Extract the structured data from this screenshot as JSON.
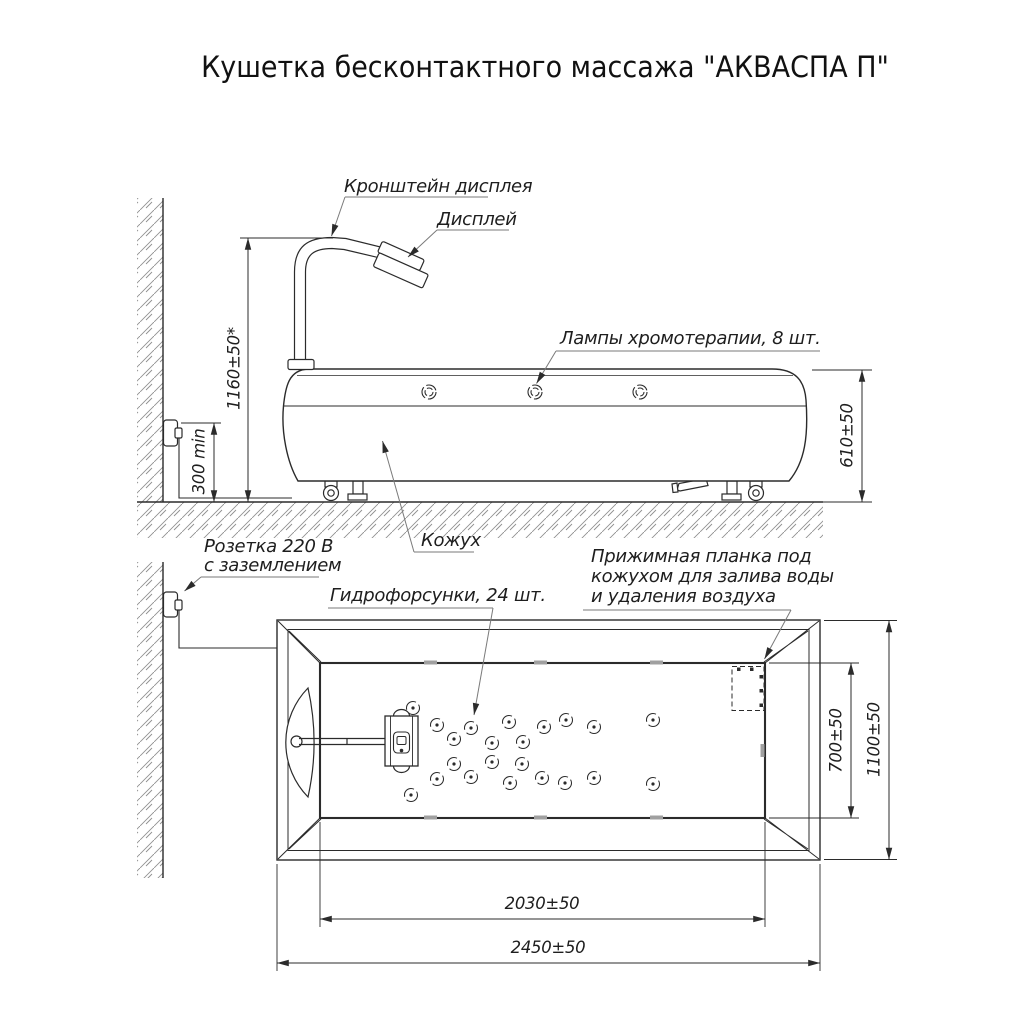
{
  "title": "Кушетка бесконтактного массажа \"АКВАСПА П\"",
  "side_view": {
    "labels": {
      "display_bracket": "Кронштейн дисплея",
      "display": "Дисплей",
      "lamps": "Лампы хромотерапии, 8 шт.",
      "casing": "Кожух",
      "socket_line1": "Розетка 220 В",
      "socket_line2": "с заземлением"
    },
    "dimensions": {
      "display_height": "1160±50*",
      "socket_height": "300 min",
      "couch_height": "610±50"
    }
  },
  "plan_view": {
    "labels": {
      "nozzles": "Гидрофорсунки, 24 шт.",
      "clamp_line1": "Прижимная планка под",
      "clamp_line2": "кожухом для залива воды",
      "clamp_line3": "и удаления воздуха"
    },
    "dimensions": {
      "basin_width": "700±50",
      "overall_width": "1100±50",
      "basin_length": "2030±50",
      "overall_length": "2450±50"
    }
  },
  "colors": {
    "line": "#2b2b2b",
    "hatch": "#909090",
    "background": "#ffffff"
  }
}
